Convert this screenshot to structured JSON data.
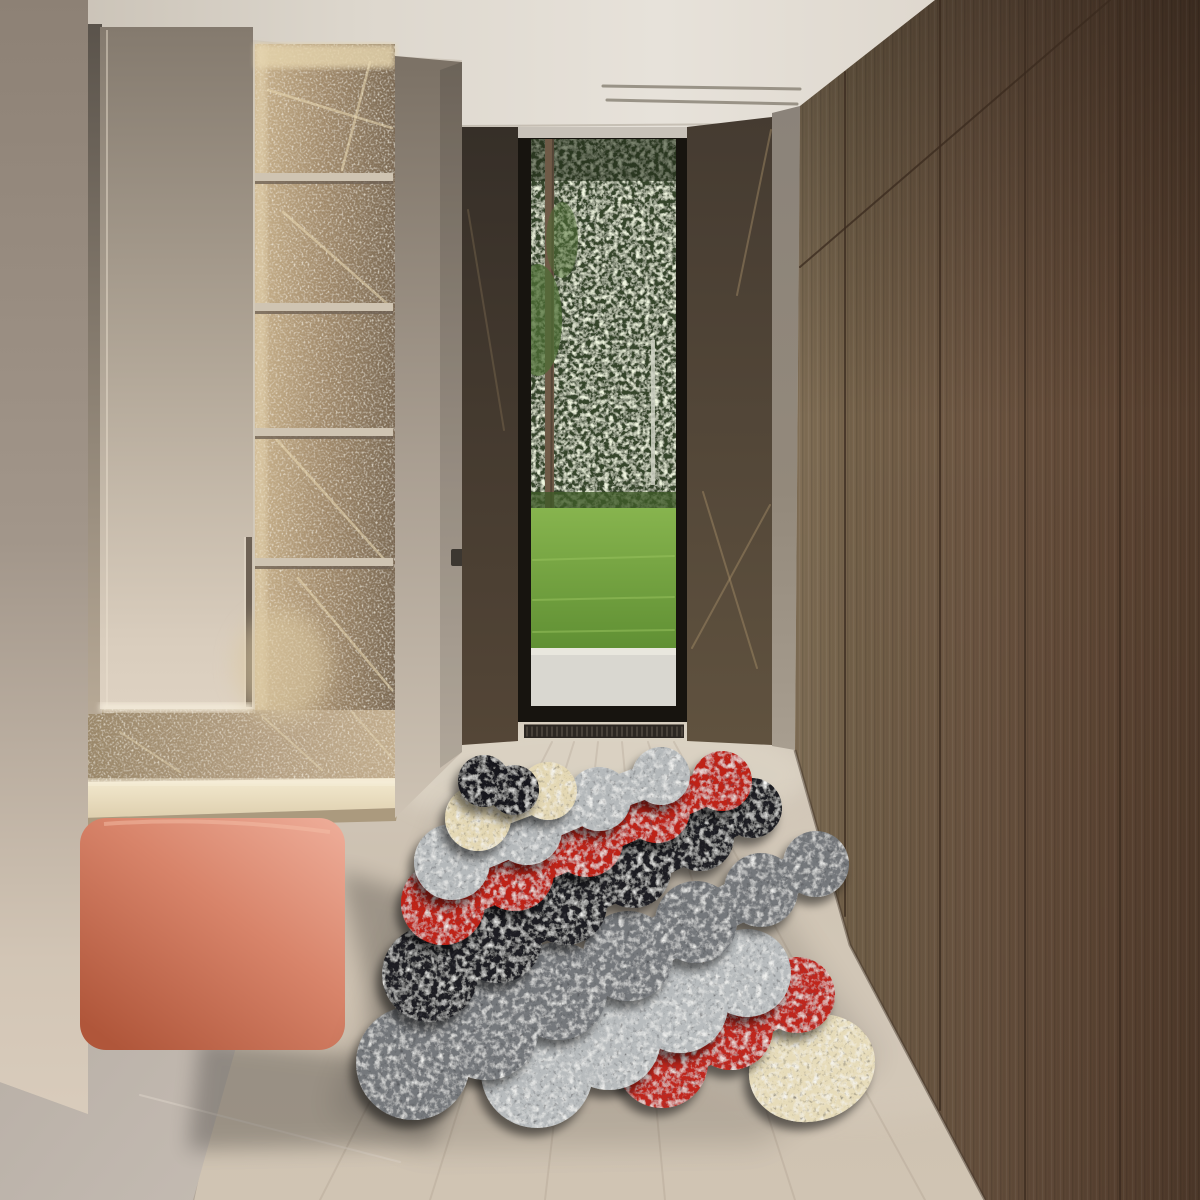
{
  "palette": {
    "ceiling_l": "#c6beb2",
    "ceiling_m": "#e7e2da",
    "ceiling_r": "#d3ccc1",
    "slot_line": "#878073",
    "wall_strip_top": "#8d8175",
    "wall_strip_bottom": "#dccfbf",
    "gap_top": "#5a534b",
    "gap_bottom": "#b7a996",
    "door_top": "#847a6e",
    "door_bottom": "#ded2c2",
    "door_glow": "#f3ead9",
    "niche_lit": "#c9b28c",
    "niche_dark": "#7c6a54",
    "niche_vein": "#ecdcb6",
    "shelf_face": "#cfc4b2",
    "shelf_shadow": "#6f6254",
    "pillar_top": "#7b7165",
    "pillar_bottom": "#cec3b4",
    "switch": "#3c3731",
    "marble_top": "#3b332b",
    "marble_bottom": "#5d5042",
    "marble_vein": "#a78f69",
    "grey_panel_top": "#8b837a",
    "grey_panel_bottom": "#a89e90",
    "blind_housing": "#c8c2b9",
    "frame": "#17140f",
    "foliage": "#35452a",
    "foliage_dark": "#202c18",
    "trunk": "#6f5a47",
    "needles": "#4e6d35",
    "birch": "#ccd0c2",
    "grass_far": "#87b44e",
    "grass_near": "#5f8f33",
    "bush": "#3f5a28",
    "path": "#d9d7d0",
    "path_light": "#e9e7de",
    "vent": "#2c2722",
    "vent_slat": "#5a5248",
    "wood_lit": "#85735a",
    "wood_mid": "#6d5642",
    "wood_dark": "#523c2c",
    "wood_seam": "#3a2a1e",
    "floor_top": "#d3cabc",
    "floor_mid": "#cbbfaf",
    "floor_bottom": "#d0c4b3",
    "plank_line": "#9c8d7c",
    "tile": "#b4aba2",
    "tile_light": "#c6bdb4",
    "tile_vein": "#ddd4c9",
    "stone_base": "#b5a083",
    "platform_top": "#ecdfc2",
    "platform_face": "#ab9a7e",
    "bench_light": "#efae9a",
    "bench_mid": "#d8846a",
    "bench_dark": "#b0563a",
    "shadow": "#000000"
  },
  "rug": {
    "note_paint_order": "first item is painted first (lowest layer)",
    "bands": [
      {
        "name": "cream-oval",
        "color": "#e7dcba",
        "type": "ellipse",
        "cx": 812,
        "cy": 1068,
        "rx": 64,
        "ry": 53,
        "rot": -18
      },
      {
        "name": "red-front",
        "color": "#c0251a",
        "circles": [
          [
            662,
            1062,
            46
          ],
          [
            731,
            1028,
            42
          ],
          [
            797,
            995,
            38
          ]
        ]
      },
      {
        "name": "lightgrey-front",
        "color": "#b8bcbe",
        "circles": [
          [
            537,
            1072,
            56
          ],
          [
            609,
            1038,
            52
          ],
          [
            680,
            1005,
            48
          ],
          [
            747,
            973,
            44
          ]
        ]
      },
      {
        "name": "grey-mid",
        "color": "#75787c",
        "circles": [
          [
            413,
            1063,
            57
          ],
          [
            486,
            1027,
            53
          ],
          [
            558,
            991,
            49
          ],
          [
            628,
            956,
            45
          ],
          [
            696,
            922,
            41
          ],
          [
            761,
            890,
            37
          ],
          [
            816,
            864,
            33
          ]
        ]
      },
      {
        "name": "black",
        "color": "#1d1e21",
        "circles": [
          [
            430,
            974,
            48
          ],
          [
            498,
            939,
            44
          ],
          [
            566,
            904,
            41
          ],
          [
            633,
            870,
            38
          ],
          [
            700,
            837,
            34
          ],
          [
            752,
            808,
            30
          ]
        ]
      },
      {
        "name": "red-back",
        "color": "#bf2319",
        "circles": [
          [
            443,
            903,
            42
          ],
          [
            515,
            872,
            39
          ],
          [
            587,
            841,
            36
          ],
          [
            657,
            810,
            33
          ],
          [
            722,
            781,
            30
          ]
        ]
      },
      {
        "name": "lightgrey-back",
        "color": "#b5b9bb",
        "circles": [
          [
            452,
            862,
            38
          ],
          [
            527,
            830,
            35
          ],
          [
            599,
            799,
            32
          ],
          [
            661,
            776,
            29
          ]
        ]
      },
      {
        "name": "cream-back",
        "color": "#e4d8b4",
        "circles": [
          [
            478,
            818,
            33
          ],
          [
            548,
            791,
            29
          ]
        ]
      },
      {
        "name": "black-small",
        "color": "#18181b",
        "circles": [
          [
            484,
            781,
            26
          ],
          [
            514,
            790,
            25
          ]
        ]
      }
    ]
  },
  "structure": {
    "shelves": {
      "x": 255,
      "w": 138,
      "h": 8,
      "ys": [
        173,
        303,
        428,
        558
      ]
    },
    "vent": {
      "x": 524,
      "y": 725,
      "w": 160,
      "h": 13,
      "gap": 5
    },
    "line_groups": [
      {
        "target": "g-slots",
        "stroke": "#878073",
        "width": 3,
        "opacity": 0.8,
        "pts": [
          [
            603,
            86,
            800,
            89
          ],
          [
            607,
            100,
            797,
            104
          ]
        ]
      },
      {
        "target": "g-planks",
        "stroke": "#9c8d7c",
        "width": 2,
        "opacity": 0.22,
        "pts": [
          [
            320,
            1200,
            552,
            742
          ],
          [
            430,
            1200,
            574,
            742
          ],
          [
            545,
            1200,
            598,
            742
          ],
          [
            665,
            1200,
            622,
            742
          ],
          [
            795,
            1200,
            648,
            742
          ],
          [
            925,
            1200,
            674,
            742
          ]
        ]
      },
      {
        "target": "g-boundary",
        "stroke": "#968c82",
        "width": 2.5,
        "opacity": 0.5,
        "pts": [
          [
            277,
            802,
            193,
            1200
          ]
        ]
      },
      {
        "target": "g-tileveins",
        "stroke": "#ddd4c9",
        "width": 2,
        "opacity": 0.5,
        "pts": [
          [
            140,
            1095,
            400,
            1162
          ],
          [
            30,
            905,
            120,
            1010
          ]
        ]
      },
      {
        "target": "g-woodseams",
        "stroke": "#3a2a1e",
        "width": 2,
        "opacity": 0.75,
        "pts": [
          [
            845,
            72,
            845,
            916
          ],
          [
            940,
            0,
            940,
            1110
          ],
          [
            1025,
            0,
            1025,
            1200
          ],
          [
            1120,
            0,
            1120,
            1200
          ],
          [
            800,
            267,
            1110,
            0
          ]
        ]
      },
      {
        "target": "g-veinsL",
        "stroke": "#a78f69",
        "width": 2,
        "opacity": 0.25,
        "pts": [
          [
            468,
            210,
            504,
            430
          ]
        ]
      },
      {
        "target": "g-veinsR",
        "stroke": "#a78f69",
        "width": 2,
        "opacity": 0.45,
        "pts": [
          [
            692,
            648,
            770,
            505
          ],
          [
            703,
            492,
            757,
            668
          ],
          [
            737,
            295,
            771,
            130
          ]
        ]
      },
      {
        "target": "g-nicheveins",
        "stroke": "#ecdcb6",
        "width": 2.5,
        "opacity": 0.55,
        "pts": [
          [
            268,
            90,
            392,
            128
          ],
          [
            370,
            62,
            342,
            170
          ],
          [
            283,
            212,
            392,
            308
          ],
          [
            268,
            430,
            392,
            568
          ],
          [
            298,
            578,
            392,
            690
          ]
        ]
      },
      {
        "target": "g-baseveins",
        "stroke": "#e6d7b4",
        "width": 2,
        "opacity": 0.5,
        "pts": [
          [
            120,
            732,
            180,
            772
          ],
          [
            262,
            716,
            322,
            770
          ],
          [
            352,
            712,
            392,
            758
          ]
        ]
      },
      {
        "target": "g-grass",
        "stroke": "#9ac45f",
        "width": 2,
        "opacity": 0.5,
        "pts": [
          [
            533,
            560,
            674,
            556
          ],
          [
            533,
            600,
            674,
            597
          ],
          [
            533,
            632,
            674,
            630
          ]
        ]
      }
    ]
  }
}
